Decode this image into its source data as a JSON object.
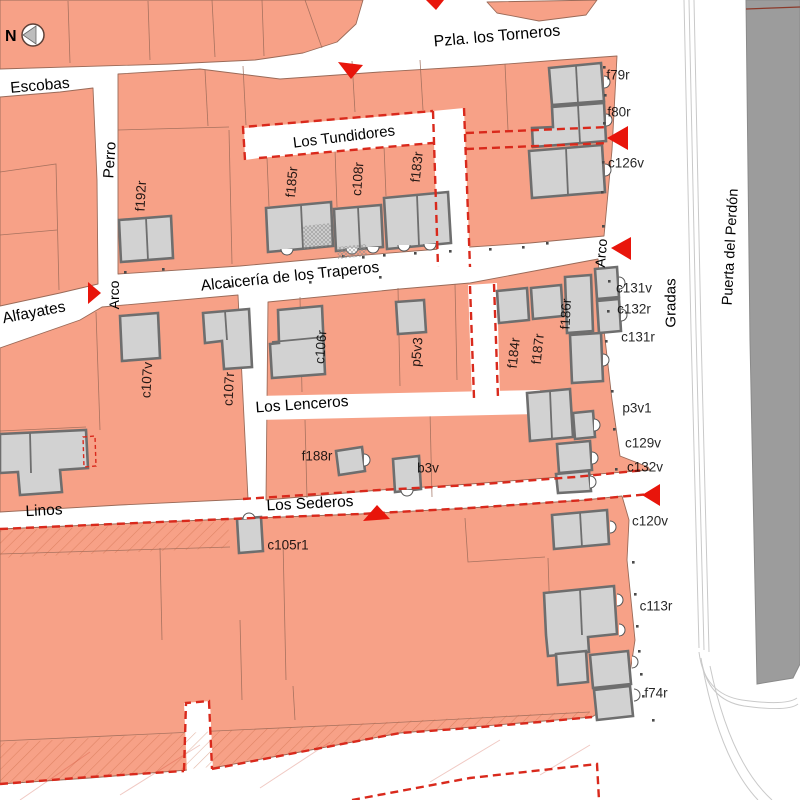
{
  "colors": {
    "block_fill": "#F7A187",
    "block_outline": "#9A6A58",
    "building_fill": "#D2D2D2",
    "building_wall": "#6E6E6E",
    "dashed_boundary_red": "#D9291C",
    "arrow_red": "#E8150B",
    "cathedral_gray": "#9C9C9C",
    "street_white": "#FFFFFF",
    "label_black": "#000000"
  },
  "compass": {
    "label": "N"
  },
  "street_labels": [
    {
      "id": "pzla-los-torneros",
      "label": "Pzla. los Torneros",
      "x": 497,
      "y": 37,
      "rot": -5,
      "size": 16
    },
    {
      "id": "escobas",
      "label": "Escobas",
      "x": 40,
      "y": 86,
      "rot": -5,
      "size": 15.5
    },
    {
      "id": "perro",
      "label": "Perro",
      "x": 110,
      "y": 160,
      "rot": -86,
      "size": 15
    },
    {
      "id": "alfayates",
      "label": "Alfayates",
      "x": 34,
      "y": 313,
      "rot": -11,
      "size": 15.5
    },
    {
      "id": "los-tundidores",
      "label": "Los Tundidores",
      "x": 344,
      "y": 137,
      "rot": -7,
      "size": 15
    },
    {
      "id": "alcaiceria-de-los-traperos",
      "label": "Alcaicería de los Traperos",
      "x": 290,
      "y": 277,
      "rot": -6,
      "size": 15.5
    },
    {
      "id": "los-lenceros",
      "label": "Los Lenceros",
      "x": 302,
      "y": 405,
      "rot": -4,
      "size": 15.5
    },
    {
      "id": "los-sederos",
      "label": "Los Sederos",
      "x": 310,
      "y": 504,
      "rot": -3,
      "size": 15.5
    },
    {
      "id": "linos",
      "label": "Linos",
      "x": 44,
      "y": 511,
      "rot": -3,
      "size": 15.5
    },
    {
      "id": "gradas",
      "label": "Gradas",
      "x": 671,
      "y": 303,
      "rot": -90,
      "size": 15
    },
    {
      "id": "puerta-del-perdon",
      "label": "Puerta del Perdón",
      "x": 731,
      "y": 247,
      "rot": -87,
      "size": 14.5
    },
    {
      "id": "arco-west",
      "label": "Arco",
      "x": 114,
      "y": 295,
      "rot": -90,
      "size": 14
    },
    {
      "id": "arco-east",
      "label": "Arco",
      "x": 601,
      "y": 253,
      "rot": -85,
      "size": 14
    }
  ],
  "building_labels": [
    {
      "id": "f192r",
      "label": "f192r",
      "x": 141,
      "y": 196,
      "rot": -87
    },
    {
      "id": "f185r",
      "label": "f185r",
      "x": 292,
      "y": 182,
      "rot": -85
    },
    {
      "id": "c108r",
      "label": "c108r",
      "x": 358,
      "y": 179,
      "rot": -86
    },
    {
      "id": "f183r",
      "label": "f183r",
      "x": 417,
      "y": 167,
      "rot": -84
    },
    {
      "id": "f79r",
      "label": "f79r",
      "x": 618,
      "y": 75,
      "rot": 0
    },
    {
      "id": "f80r",
      "label": "f80r",
      "x": 619,
      "y": 112,
      "rot": 0
    },
    {
      "id": "c126v",
      "label": "c126v",
      "x": 626,
      "y": 163,
      "rot": 0
    },
    {
      "id": "c131v",
      "label": "c131v",
      "x": 634,
      "y": 288,
      "rot": 0
    },
    {
      "id": "c132r",
      "label": "c132r",
      "x": 634,
      "y": 309,
      "rot": 0
    },
    {
      "id": "c131r",
      "label": "c131r",
      "x": 638,
      "y": 337,
      "rot": 0
    },
    {
      "id": "f186r",
      "label": "f186r",
      "x": 566,
      "y": 314,
      "rot": -87
    },
    {
      "id": "f184r",
      "label": "f184r",
      "x": 514,
      "y": 353,
      "rot": -84
    },
    {
      "id": "f187r",
      "label": "f187r",
      "x": 538,
      "y": 349,
      "rot": -84
    },
    {
      "id": "c107v",
      "label": "c107v",
      "x": 147,
      "y": 380,
      "rot": -87
    },
    {
      "id": "c107r",
      "label": "c107r",
      "x": 229,
      "y": 389,
      "rot": -87
    },
    {
      "id": "c106r",
      "label": "c106r",
      "x": 321,
      "y": 347,
      "rot": -86
    },
    {
      "id": "p5v3",
      "label": "p5v3",
      "x": 417,
      "y": 352,
      "rot": -85
    },
    {
      "id": "p3v1",
      "label": "p3v1",
      "x": 637,
      "y": 408,
      "rot": 0
    },
    {
      "id": "c129v",
      "label": "c129v",
      "x": 643,
      "y": 443,
      "rot": 0
    },
    {
      "id": "c132v",
      "label": "c132v",
      "x": 645,
      "y": 467,
      "rot": 0
    },
    {
      "id": "c120v",
      "label": "c120v",
      "x": 650,
      "y": 521,
      "rot": 0
    },
    {
      "id": "c113r",
      "label": "c113r",
      "x": 656,
      "y": 606,
      "rot": 0
    },
    {
      "id": "f74r",
      "label": "f74r",
      "x": 656,
      "y": 693,
      "rot": 0
    },
    {
      "id": "f188r",
      "label": "f188r",
      "x": 317,
      "y": 456,
      "rot": 0
    },
    {
      "id": "b3v",
      "label": "b3v",
      "x": 428,
      "y": 468,
      "rot": 0
    },
    {
      "id": "c105r1",
      "label": "c105r1",
      "x": 288,
      "y": 545,
      "rot": 0
    }
  ]
}
